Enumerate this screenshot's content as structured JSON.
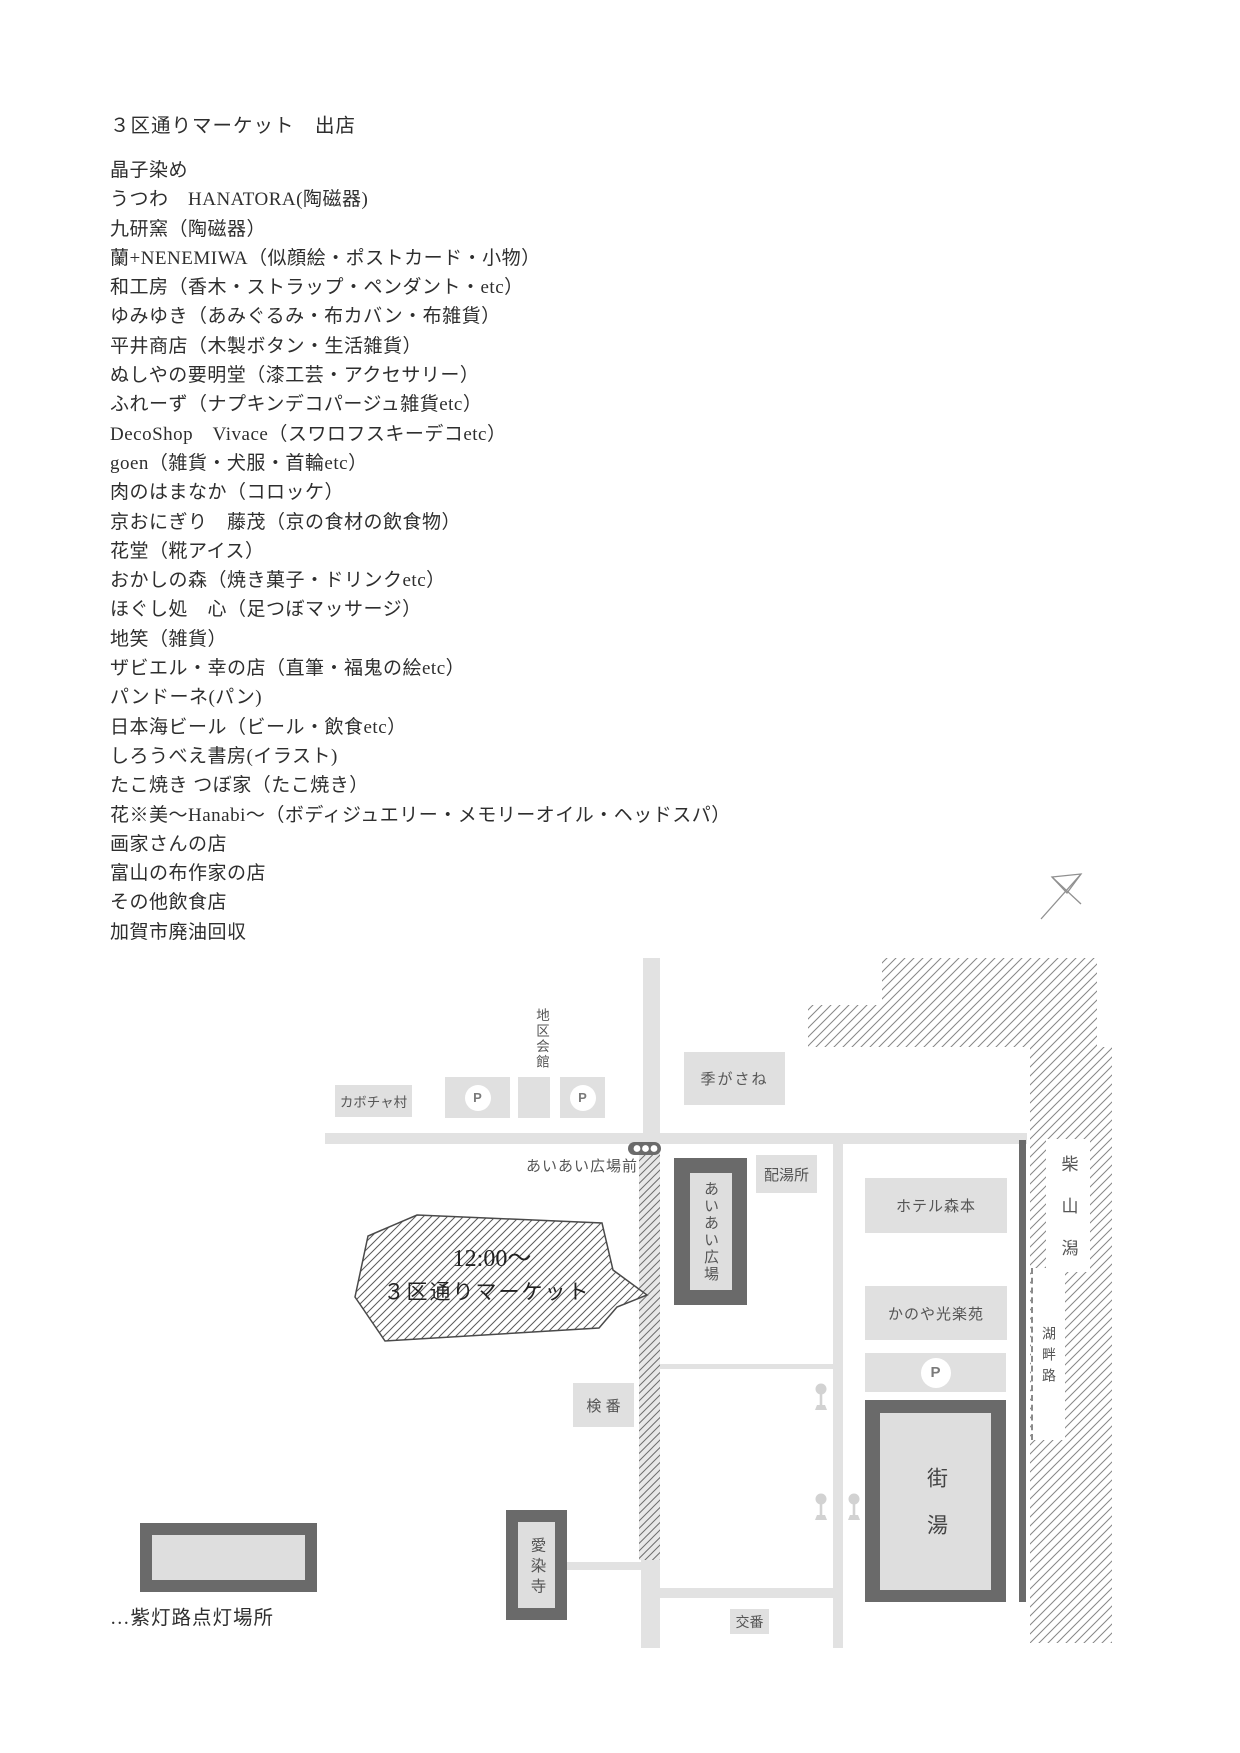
{
  "page": {
    "title": "３区通りマーケット　出店"
  },
  "vendors": {
    "items": [
      "晶子染め",
      "うつわ　HANATORA(陶磁器)",
      "九研窯（陶磁器）",
      "蘭+NENEMIWA（似顔絵・ポストカード・小物）",
      "和工房（香木・ストラップ・ペンダント・etc）",
      "ゆみゆき（あみぐるみ・布カバン・布雑貨）",
      "平井商店（木製ボタン・生活雑貨）",
      "ぬしやの要明堂（漆工芸・アクセサリー）",
      "ふれーず（ナプキンデコパージュ雑貨etc）",
      "DecoShop　Vivace（スワロフスキーデコetc）",
      "goen（雑貨・犬服・首輪etc）",
      "肉のはまなか（コロッケ）",
      "京おにぎり　藤茂（京の食材の飲食物）",
      "花堂（糀アイス）",
      "おかしの森（焼き菓子・ドリンクetc）",
      "ほぐし処　心（足つぼマッサージ）",
      "地笑（雑貨）",
      "ザビエル・幸の店（直筆・福鬼の絵etc）",
      "パンドーネ(パン)",
      "日本海ビール（ビール・飲食etc）",
      "しろうべえ書房(イラスト)",
      "たこ焼き つぼ家（たこ焼き）",
      "花※美〜Hanabi〜（ボディジュエリー・メモリーオイル・ヘッドスパ）",
      "画家さんの店",
      "富山の布作家の店",
      "その他飲食店",
      "加賀市廃油回収"
    ]
  },
  "map": {
    "labels": {
      "chiku_kaikan": "地区会館",
      "kabocha_village": "カボチャ村",
      "parking": "P",
      "kigasane": "季がさね",
      "aiai_hiroba_mae": "あいあい広場前",
      "aiai_hiroba": "あいあい広場",
      "haitoujo": "配湯所",
      "hotel_morimoto": "ホテル森本",
      "kanoya_kourakuen": "かのや光楽苑",
      "machiyu": "街湯",
      "kenban": "検 番",
      "aizenji": "愛染寺",
      "kouban": "交番",
      "shibayamagata": "柴山潟",
      "kohanro": "湖畔路"
    },
    "bubble": {
      "line1": "12:00〜",
      "line2": "３区通りマーケット"
    },
    "legend": {
      "text": "…紫灯路点灯場所"
    },
    "colors": {
      "road": "#e2e2e2",
      "box_fill": "#e0e0e0",
      "frame_dark": "#6a6a6a",
      "label_text": "#555555",
      "ink": "#2e2e2e"
    }
  }
}
